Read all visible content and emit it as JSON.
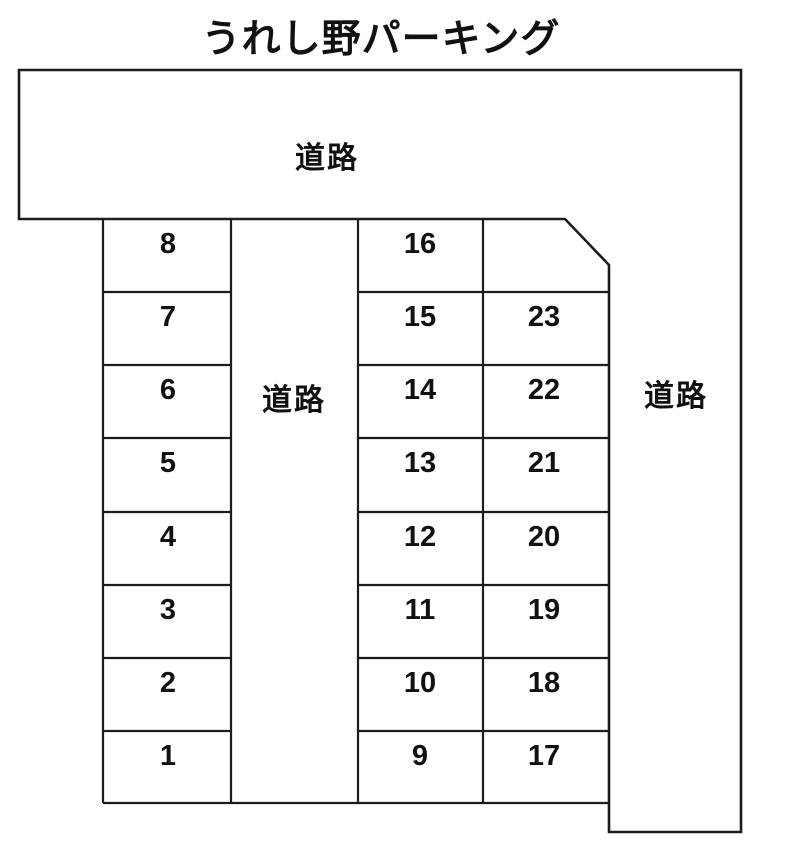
{
  "title": "うれし野パーキング",
  "road_labels": {
    "top": "道路",
    "middle": "道路",
    "right": "道路"
  },
  "parking": {
    "left_column_top_to_bottom": [
      "8",
      "7",
      "6",
      "5",
      "4",
      "3",
      "2",
      "1"
    ],
    "middle_column_top_to_bottom": [
      "16",
      "15",
      "14",
      "13",
      "12",
      "11",
      "10",
      "9"
    ],
    "right_column_top_to_bottom": [
      "23",
      "22",
      "21",
      "20",
      "19",
      "18",
      "17"
    ],
    "total_numbered_spaces": 23
  },
  "colors": {
    "line": "#1c1c1c",
    "text": "#111111",
    "background": "#ffffff"
  }
}
